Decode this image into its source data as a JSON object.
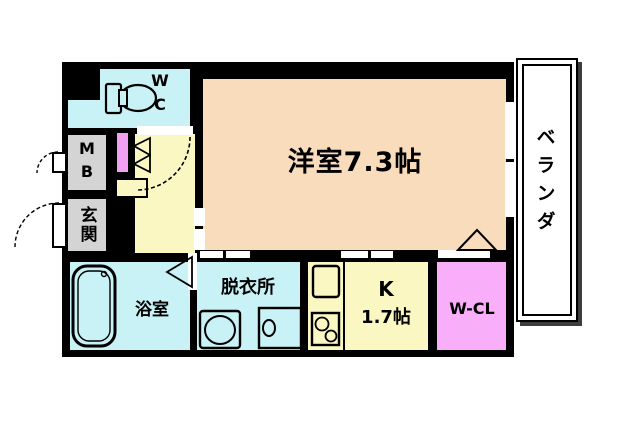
{
  "plan_title": "apartment floor plan",
  "rooms": {
    "main": {
      "label": "洋室7.3帖"
    },
    "veranda": {
      "label": "ベランダ"
    },
    "wc": {
      "line1": "W",
      "line2": "C"
    },
    "mb": {
      "line1": "M",
      "line2": "B"
    },
    "genkan": {
      "label": "玄関"
    },
    "bath": {
      "label": "浴室"
    },
    "dressing": {
      "label": "脱衣所"
    },
    "kitchen": {
      "line1": "K",
      "line2": "1.7帖"
    },
    "wcl": {
      "label": "W-CL"
    }
  },
  "colors": {
    "wall": "#000000",
    "background": "#ffffff",
    "main_room": "#f9dcbc",
    "hallway_yellow": "#faf7c3",
    "wet_area_cyan": "#c8f2f6",
    "closet_pink": "#f8aef8",
    "door_pink": "#f2a0f2",
    "gray_box": "#d4d4d4",
    "veranda_shadow": "#3d3d3d"
  },
  "fixtures": [
    "toilet",
    "bathtub",
    "washing-machine",
    "washbasin",
    "kitchen-sink",
    "stove"
  ]
}
